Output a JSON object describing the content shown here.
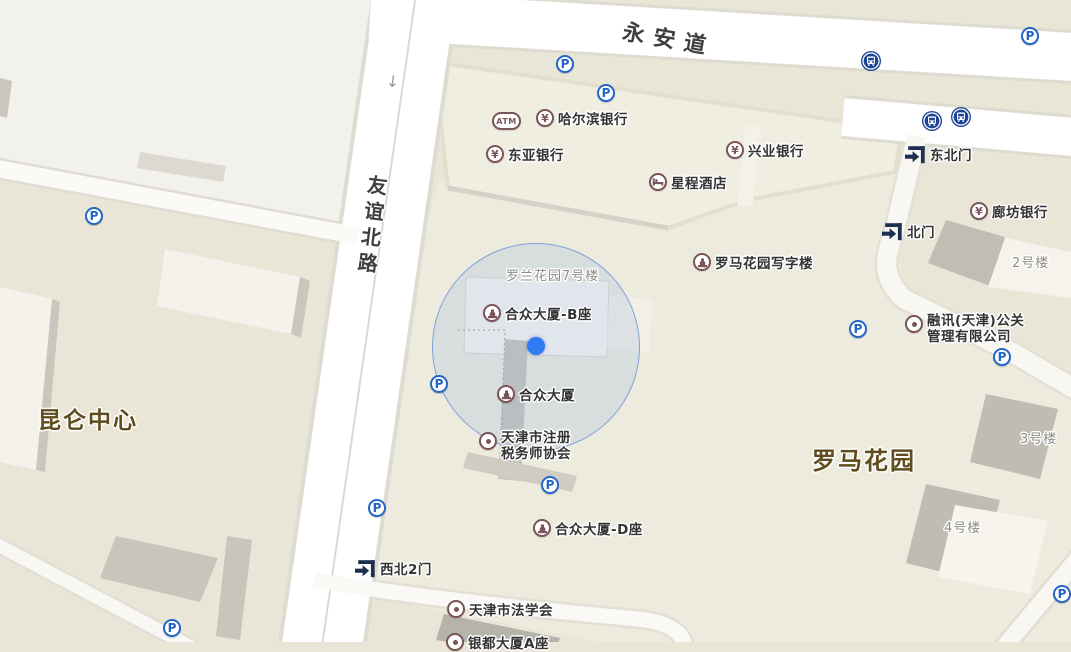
{
  "map": {
    "icons": {
      "parking": "P",
      "bank": "¥",
      "atm": "ATM"
    },
    "roads": [
      {
        "label": "永安道"
      },
      {
        "label": "友谊北路"
      }
    ],
    "areas": [
      {
        "label": "昆仑中心"
      },
      {
        "label": "罗马花园"
      }
    ],
    "buildings": [
      {
        "label": "罗兰花园7号楼"
      },
      {
        "label": "2号楼"
      },
      {
        "label": "3号楼"
      },
      {
        "label": "4号楼"
      }
    ],
    "pois": [
      {
        "label": "哈尔滨银行",
        "type": "bank"
      },
      {
        "label": "东亚银行",
        "type": "bank"
      },
      {
        "label": "兴业银行",
        "type": "bank"
      },
      {
        "label": "廊坊银行",
        "type": "bank"
      },
      {
        "label": "星程酒店",
        "type": "hotel"
      },
      {
        "label": "东北门",
        "type": "gate"
      },
      {
        "label": "北门",
        "type": "gate"
      },
      {
        "label": "西北2门",
        "type": "gate"
      },
      {
        "label": "罗马花园写字楼",
        "type": "office-building"
      },
      {
        "label": "合众大厦-B座",
        "type": "office-building"
      },
      {
        "label": "合众大厦",
        "type": "office-building"
      },
      {
        "label": "合众大厦-D座",
        "type": "office-building"
      },
      {
        "label": "融讯(天津)公关",
        "label2": "管理有限公司",
        "type": "company"
      },
      {
        "label": "天津市注册",
        "label2": "税务师协会",
        "type": "organization"
      },
      {
        "label": "天津市法学会",
        "type": "organization"
      },
      {
        "label": "银都大厦A座",
        "type": "building",
        "note": "partially visible at bottom edge"
      }
    ],
    "markers": {
      "parking_count": 11,
      "bus_stop_count": 3,
      "current_location": true,
      "oneway_arrow": "↓"
    },
    "colors": {
      "base_land": "#e9e6d8",
      "light_block": "#f2f1ec",
      "road_fill": "#ffffff",
      "poi_icon": "#7a5557",
      "parking_blue": "#2265c6",
      "bus_navy": "#1d4596",
      "gate_navy": "#1c3150",
      "poi_text": "#333333",
      "gray_label": "#8f8c84",
      "area_label_brown": "#5f4d1e",
      "road_label": "#3f3f3f",
      "location_dot": "#2e7bf3",
      "accuracy_circle": "#6e96dc"
    }
  }
}
